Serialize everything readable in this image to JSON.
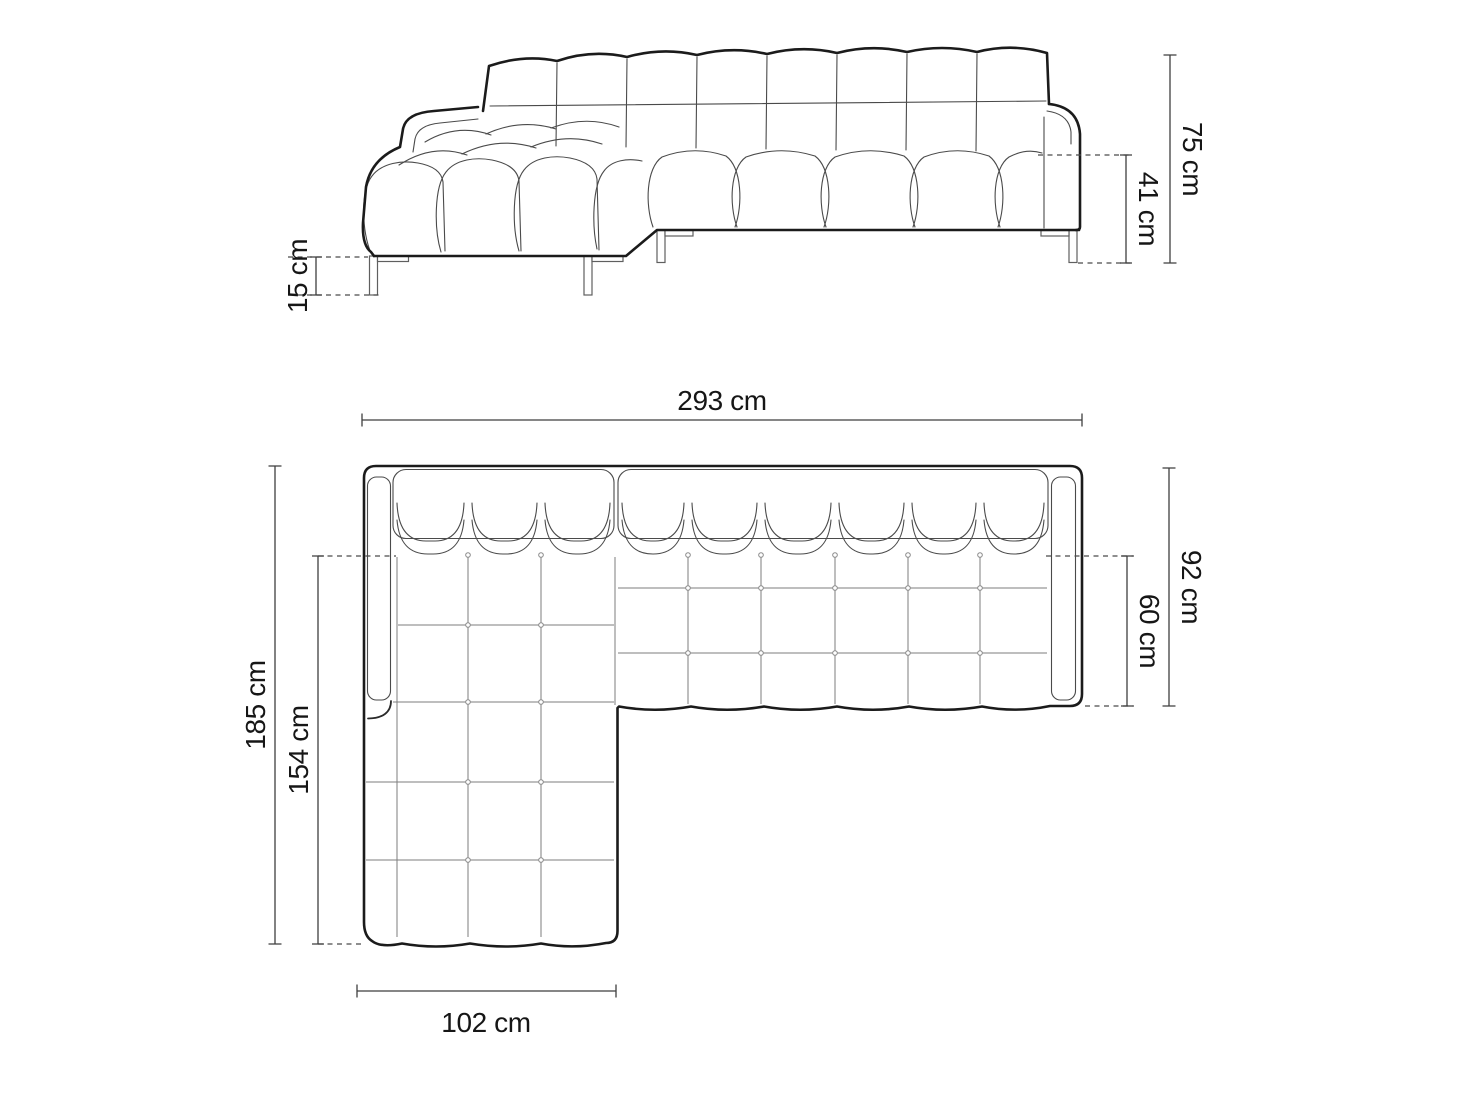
{
  "diagram": {
    "background": "#ffffff",
    "outline_color": "#1b1b1b",
    "detail_color": "#4a4a4a",
    "grid_color": "#7d7d7d",
    "dimension_color": "#3f3f3f",
    "label_color": "#161616",
    "unit": "cm",
    "side_view": {
      "dimensions": [
        {
          "id": "total-height",
          "label": "75 cm"
        },
        {
          "id": "seat-height",
          "label": "41 cm"
        },
        {
          "id": "leg-height",
          "label": "15 cm"
        }
      ]
    },
    "top_view": {
      "dimensions": [
        {
          "id": "total-width",
          "label": "293 cm"
        },
        {
          "id": "total-depth",
          "label": "185 cm"
        },
        {
          "id": "chaise-depth",
          "label": "154 cm"
        },
        {
          "id": "chaise-width",
          "label": "102 cm"
        },
        {
          "id": "body-depth",
          "label": "92 cm"
        },
        {
          "id": "seat-depth",
          "label": "60 cm"
        }
      ]
    }
  }
}
